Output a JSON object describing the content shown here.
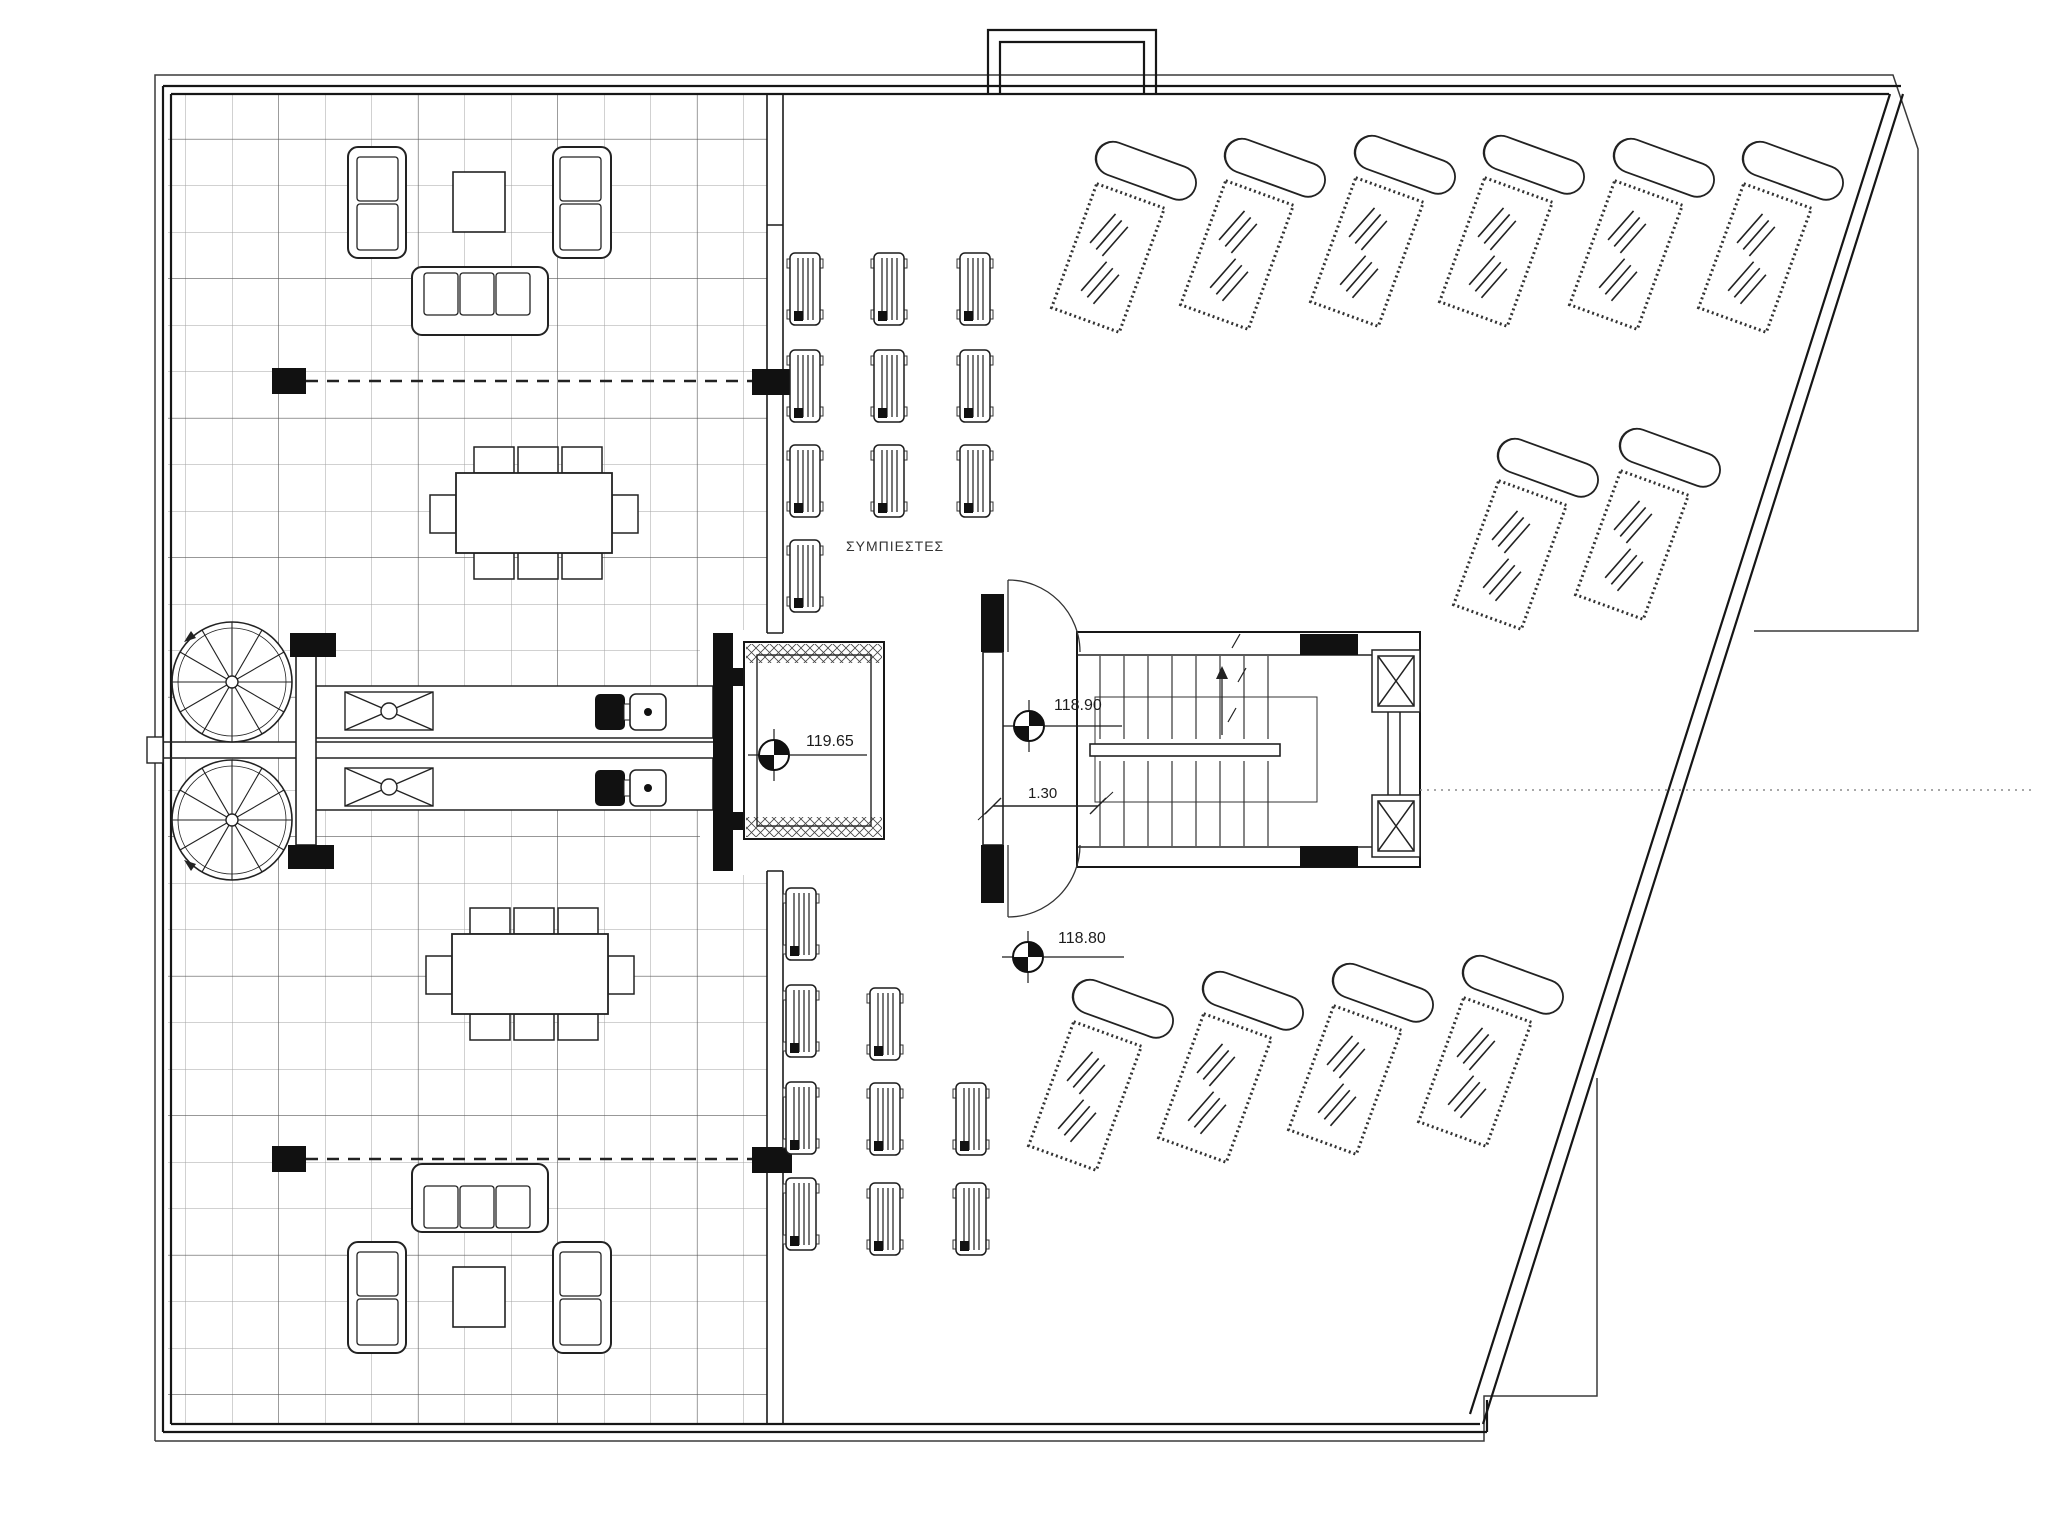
{
  "drawing": {
    "type": "roof-terrace-floor-plan",
    "paper_color": "#ffffff"
  },
  "labels": {
    "compressors": "ΣΥΜΠΙΕΣΤΕΣ",
    "level_top": "119.65",
    "level_stair": "118.90",
    "level_landing": "118.80",
    "stair_width": "1.30"
  },
  "colors": {
    "ink": "#1c1c1c",
    "grid": "#a3a3a3",
    "grid_dark": "#555555",
    "fill_black": "#111111"
  },
  "level_markers": [
    {
      "label_key": "level_top",
      "cx": 774,
      "cy": 755,
      "leader_x2": 867
    },
    {
      "label_key": "level_stair",
      "cx": 1029,
      "cy": 726,
      "leader_x2": 1122
    },
    {
      "label_key": "level_landing",
      "cx": 1028,
      "cy": 957,
      "leader_x2": 1124
    }
  ],
  "equipment": {
    "compressor_unit_size": [
      30,
      72
    ],
    "compressor_units": [
      [
        790,
        253
      ],
      [
        790,
        350
      ],
      [
        790,
        445
      ],
      [
        790,
        540
      ],
      [
        874,
        253
      ],
      [
        874,
        350
      ],
      [
        874,
        445
      ],
      [
        960,
        253
      ],
      [
        960,
        350
      ],
      [
        960,
        445
      ],
      [
        786,
        888
      ],
      [
        786,
        985
      ],
      [
        786,
        1082
      ],
      [
        786,
        1178
      ],
      [
        870,
        988
      ],
      [
        870,
        1083
      ],
      [
        870,
        1183
      ],
      [
        956,
        1083
      ],
      [
        956,
        1183
      ]
    ]
  },
  "sun_loungers": {
    "rotation_deg": 20,
    "centers": [
      [
        1108,
        258
      ],
      [
        1237,
        255
      ],
      [
        1367,
        252
      ],
      [
        1496,
        252
      ],
      [
        1626,
        255
      ],
      [
        1755,
        258
      ],
      [
        1510,
        555
      ],
      [
        1632,
        545
      ],
      [
        1085,
        1096
      ],
      [
        1215,
        1088
      ],
      [
        1345,
        1080
      ],
      [
        1475,
        1072
      ]
    ]
  },
  "spiral_stairs": {
    "radius": 60,
    "spokes": 12,
    "centers": [
      [
        232,
        682
      ],
      [
        232,
        820
      ]
    ]
  },
  "main_stair_treads": {
    "x_start": 1100,
    "x_end": 1268,
    "step": 24,
    "upper_run": [
      656,
      739
    ],
    "lower_run": [
      761,
      846
    ]
  }
}
